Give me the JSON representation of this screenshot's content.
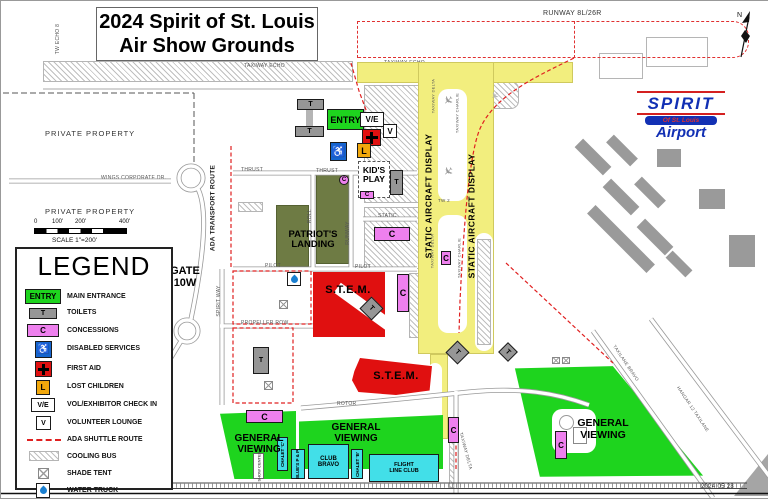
{
  "title": {
    "line1": "2024 Spirit of St. Louis",
    "line2": "Air Show Grounds"
  },
  "runway_label": "RUNWAY 8L/26R",
  "compass_n": "N",
  "date_stamp": "2024 05 28",
  "logo": {
    "name": "SPIRIT",
    "sub": "Of St. Louis",
    "airport": "Airport"
  },
  "private_property": "PRIVATE PROPERTY",
  "gate": "GATE 10W",
  "scale": {
    "t0": "0",
    "t100": "100'",
    "t200": "200'",
    "t400": "400'",
    "label": "SCALE 1\"=200'"
  },
  "legend": {
    "title": "LEGEND",
    "items": [
      {
        "label": "MAIN ENTRANCE"
      },
      {
        "label": "TOILETS"
      },
      {
        "label": "CONCESSIONS"
      },
      {
        "label": "DISABLED SERVICES"
      },
      {
        "label": "FIRST AID"
      },
      {
        "label": "LOST CHILDREN"
      },
      {
        "label": "VOL/EXHIBITOR CHECK IN"
      },
      {
        "label": "VOLUNTEER LOUNGE"
      },
      {
        "label": "ADA SHUTTLE ROUTE"
      },
      {
        "label": "COOLING BUS"
      },
      {
        "label": "SHADE TENT"
      },
      {
        "label": "WATER TRUCK"
      }
    ]
  },
  "markers": {
    "entry": "ENTRY",
    "toilet": "T",
    "concession": "C",
    "volunteer": "V",
    "vol_exhibitor": "V/E",
    "lost_children": "L",
    "wheelchair": "♿"
  },
  "areas": {
    "patriots_landing": "PATRIOT'S LANDING",
    "stem": "S.T.E.M.",
    "general_viewing": "GENERAL VIEWING",
    "kids_play": "KID'S PLAY",
    "static_display": "STATIC AIRCRAFT DISPLAY",
    "ada_route": "ADA TRANSPORT ROUTE"
  },
  "venues": {
    "chalet_c": "CHALET 'C'",
    "blues": "BLUE'S P & P",
    "club_bravo": "CLUB BRAVO",
    "chalet_b": "CHALET 'B'",
    "flight_line": "FLIGHT LINE CLUB",
    "show_center": "SHOW CENTER"
  },
  "streets": {
    "taxiway_echo": "TAXIWAY ECHO",
    "tw_echo8": "TW ECHO 8",
    "thrust": "THRUST",
    "static": "STATIC",
    "pilot": "PILOT",
    "propeller": "PROPELLER ROW",
    "spirit_way": "SPIRIT WAY",
    "roll": "ROLL",
    "runway": "RUNWAY",
    "rotor": "ROTOR",
    "tw2": "TW 2",
    "taxiway_delta": "TAXIWAY DELTA",
    "taxiway_charlie": "TAXIWAY CHARLIE",
    "taxilane_bravo": "TAXILANE BRAVO",
    "hangar12": "HANGAR 12 TAXILANE",
    "wings": "WINGS CORPORATE DR."
  },
  "colors": {
    "yellow": "#f2ee7e",
    "green": "#1ed41e",
    "red": "#e01010",
    "olive": "#6e7b44",
    "pink": "#ee80ee",
    "cyan": "#42dfe8",
    "blue": "#1565cf",
    "orange": "#f2a80c"
  }
}
